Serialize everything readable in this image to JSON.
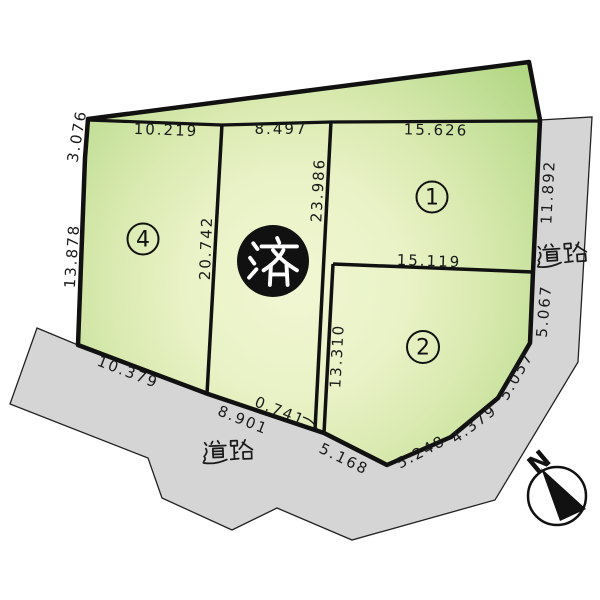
{
  "diagram": {
    "type": "land-plot-map",
    "labels": {
      "road": "道路",
      "sold": "済",
      "north": "N"
    },
    "plots": [
      {
        "number": "1"
      },
      {
        "number": "2"
      },
      {
        "number": "4"
      }
    ],
    "dimensions": {
      "top_plot4": "10.219",
      "top_sold": "8.497",
      "top_plot1": "15.626",
      "left_upper": "3.076",
      "left_lower": "13.878",
      "divider_4_sold": "20.742",
      "divider_sold_1": "23.986",
      "right_plot1": "11.892",
      "divider_1_2": "15.119",
      "left_plot2": "13.310",
      "right_plot2_upper": "5.067",
      "curve_upper": "5.057",
      "curve_mid": "4.379",
      "curve_lower": "5.248",
      "bottom_plot2": "5.168",
      "bottom_gap": "0.741",
      "bottom_sold": "8.901",
      "bottom_plot4": "10.379"
    },
    "colors": {
      "background": "#ffffff",
      "road_fill": "#d5d5d5",
      "outline": "#111111",
      "text": "#1a1a1a",
      "green_center": "#f1f7d3",
      "green_edge": "#b0d681"
    }
  }
}
